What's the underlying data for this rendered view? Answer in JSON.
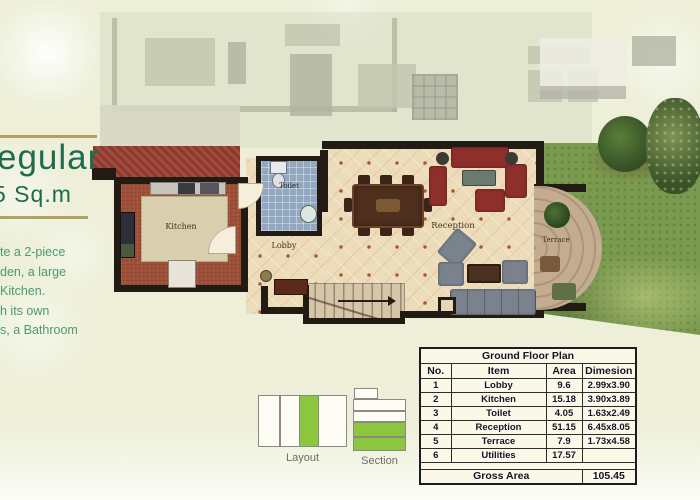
{
  "left_panel": {
    "title_fragment": "egular",
    "subtitle_fragment": "5 Sq.m",
    "description_lines": [
      "te a 2-piece",
      "den, a large",
      "Kitchen.",
      "h its own",
      "s, a Bathroom"
    ]
  },
  "floor_plan": {
    "room_labels": {
      "kitchen": "Kitchen",
      "toilet": "Toilet",
      "lobby": "Lobby",
      "reception": "Reception",
      "terrace": "Terrace"
    }
  },
  "diagrams": {
    "layout_label": "Layout",
    "section_label": "Section"
  },
  "table": {
    "title": "Ground Floor Plan",
    "headers": [
      "No.",
      "Item",
      "Area",
      "Dimesion"
    ],
    "rows": [
      [
        "1",
        "Lobby",
        "9.6",
        "2.99x3.90"
      ],
      [
        "2",
        "Kitchen",
        "15.18",
        "3.90x3.89"
      ],
      [
        "3",
        "Toilet",
        "4.05",
        "1.63x2.49"
      ],
      [
        "4",
        "Reception",
        "51.15",
        "6.45x8.05"
      ],
      [
        "5",
        "Terrace",
        "7.9",
        "1.73x4.58"
      ],
      [
        "6",
        "Utilities",
        "17.57",
        ""
      ]
    ],
    "gross_label": "Gross Area",
    "gross_value": "105.45"
  },
  "colors": {
    "page_bg": "#edefd8",
    "title_green": "#1d6b50",
    "body_green": "#4b9a6d",
    "gold_line": "#a6944c",
    "diagram_green": "#8cc63f",
    "grass": "#7a9a4f",
    "roof_red": "#9e4437",
    "wall_black": "#211b14",
    "tile_floor": "#ecdcba",
    "toilet_blue": "#92a8c0",
    "table_bg": "#fcf8e8"
  }
}
